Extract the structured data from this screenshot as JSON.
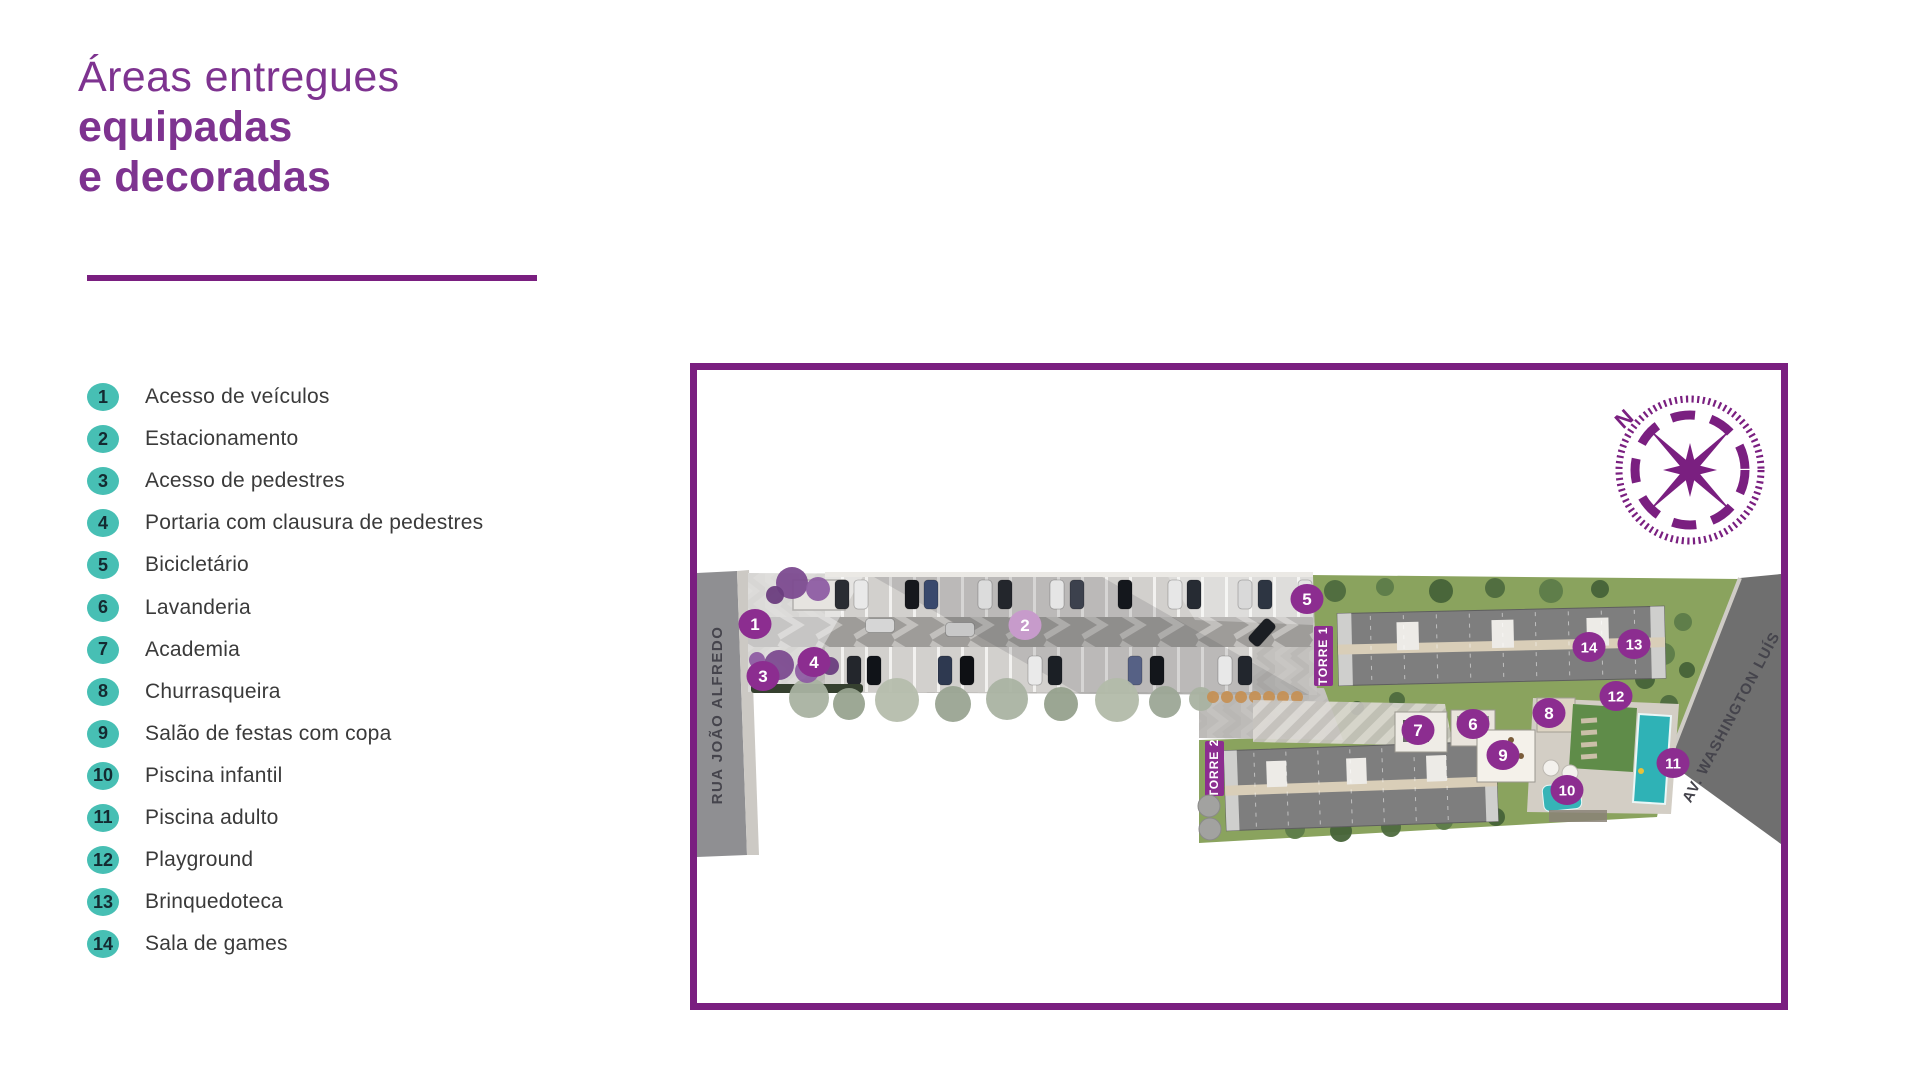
{
  "title": {
    "line1": "Áreas entregues",
    "line2": "equipadas",
    "line3": "e decoradas"
  },
  "legend": {
    "items": [
      {
        "num": "1",
        "label": "Acesso de veículos"
      },
      {
        "num": "2",
        "label": "Estacionamento"
      },
      {
        "num": "3",
        "label": "Acesso de pedestres"
      },
      {
        "num": "4",
        "label": "Portaria com clausura de pedestres"
      },
      {
        "num": "5",
        "label": "Bicicletário"
      },
      {
        "num": "6",
        "label": "Lavanderia"
      },
      {
        "num": "7",
        "label": "Academia"
      },
      {
        "num": "8",
        "label": "Churrasqueira"
      },
      {
        "num": "9",
        "label": "Salão de festas com copa"
      },
      {
        "num": "10",
        "label": "Piscina infantil"
      },
      {
        "num": "11",
        "label": "Piscina adulto"
      },
      {
        "num": "12",
        "label": "Playground"
      },
      {
        "num": "13",
        "label": "Brinquedoteca"
      },
      {
        "num": "14",
        "label": "Sala de games"
      }
    ]
  },
  "map": {
    "street_left": "RUA JOÃO ALFREDO",
    "street_right": "AV. WASHINGTON LUÍS",
    "tower1": "TORRE 1",
    "tower2": "TORRE 2",
    "compass_north": "N",
    "markers": [
      {
        "num": "1",
        "x": 58,
        "y": 254,
        "variant": "solid"
      },
      {
        "num": "2",
        "x": 328,
        "y": 255,
        "variant": "faded"
      },
      {
        "num": "3",
        "x": 66,
        "y": 306,
        "variant": "solid"
      },
      {
        "num": "4",
        "x": 117,
        "y": 292,
        "variant": "solid"
      },
      {
        "num": "5",
        "x": 610,
        "y": 229,
        "variant": "solid"
      },
      {
        "num": "6",
        "x": 776,
        "y": 354,
        "variant": "solid"
      },
      {
        "num": "7",
        "x": 721,
        "y": 360,
        "variant": "solid"
      },
      {
        "num": "8",
        "x": 852,
        "y": 343,
        "variant": "solid"
      },
      {
        "num": "9",
        "x": 806,
        "y": 385,
        "variant": "solid"
      },
      {
        "num": "10",
        "x": 870,
        "y": 420,
        "variant": "solid"
      },
      {
        "num": "11",
        "x": 976,
        "y": 393,
        "variant": "solid"
      },
      {
        "num": "12",
        "x": 919,
        "y": 326,
        "variant": "solid"
      },
      {
        "num": "13",
        "x": 937,
        "y": 274,
        "variant": "solid"
      },
      {
        "num": "14",
        "x": 892,
        "y": 277,
        "variant": "solid"
      }
    ]
  },
  "colors": {
    "purple_primary": "#7A1F80",
    "title_purple": "#7E3390",
    "marker_purple": "#8C2D90",
    "marker_faded": "#C79BCB",
    "badge_teal": "#47BFB4",
    "pool_teal": "#2FB2B6",
    "site_green": "#8AA35E",
    "street_gray": "#8F8F92",
    "avenue_gray": "#6F6F6F"
  }
}
